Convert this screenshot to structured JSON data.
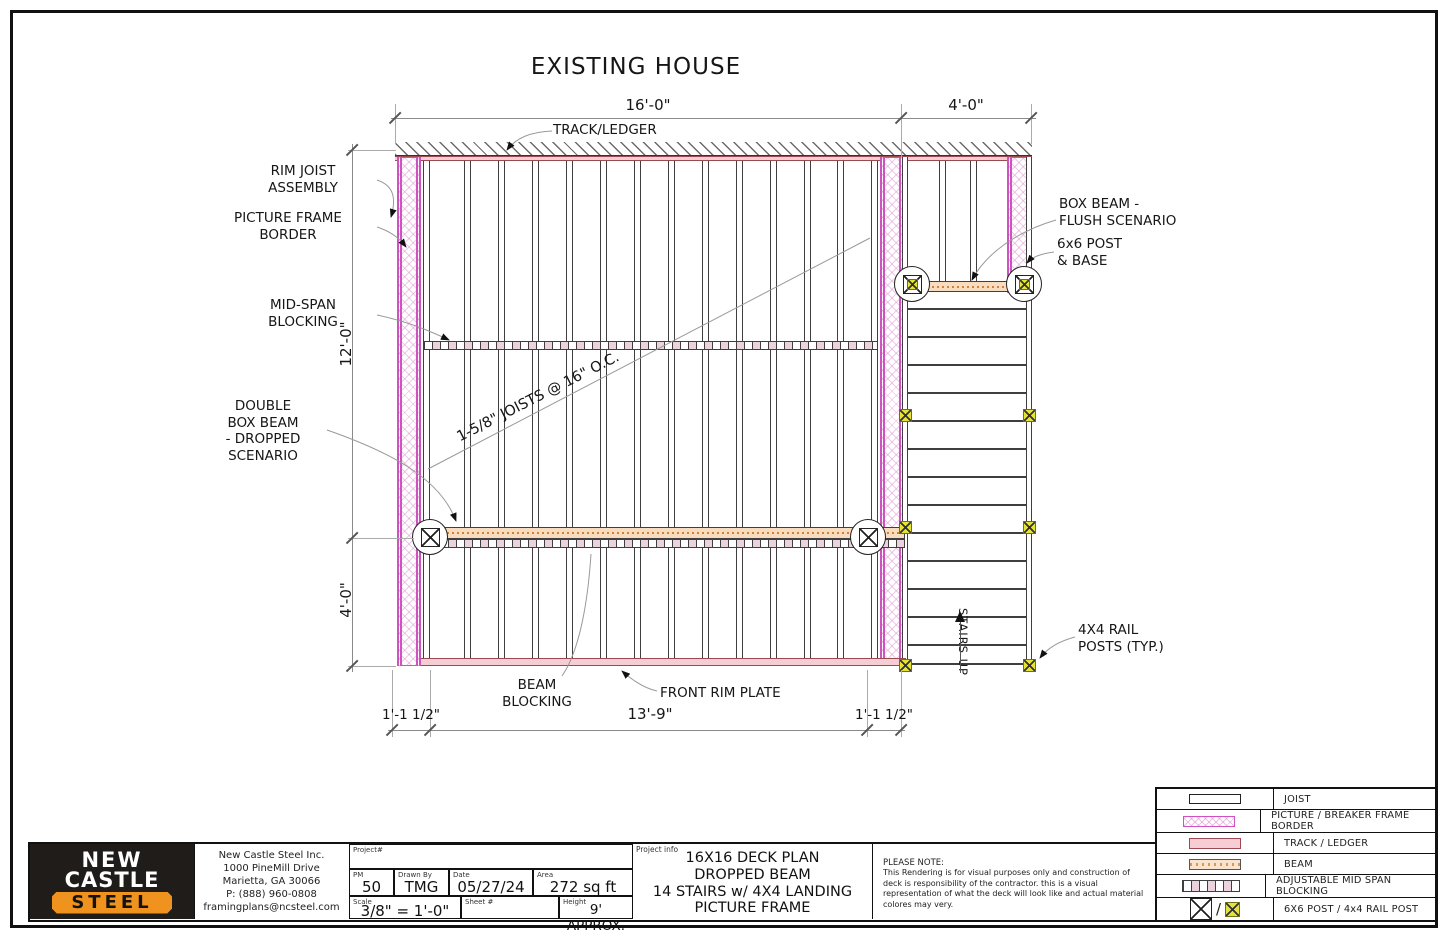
{
  "sheet": {
    "title": "EXISTING HOUSE"
  },
  "dimensions": {
    "top_main": "16'-0\"",
    "top_landing": "4'-0\"",
    "left_upper": "12'-0\"",
    "left_lower": "4'-0\"",
    "bottom_left": "1'-1 1/2\"",
    "bottom_mid": "13'-9\"",
    "bottom_right": "1'-1 1/2\""
  },
  "annotations": {
    "track_ledger": "TRACK/LEDGER",
    "rim_joist": "RIM JOIST\nASSEMBLY",
    "picture_frame": "PICTURE FRAME\nBORDER",
    "mid_span": "MID-SPAN\nBLOCKING",
    "double_box_beam": "DOUBLE\nBOX BEAM\n- DROPPED\nSCENARIO",
    "box_beam_flush": "BOX BEAM -\nFLUSH SCENARIO",
    "post_base": "6x6 POST\n& BASE",
    "rail_posts": "4X4 RAIL\nPOSTS (TYP.)",
    "beam_blocking": "BEAM\nBLOCKING",
    "front_rim_plate": "FRONT RIM PLATE",
    "joists_note": "1-5/8\" JOISTS @ 16\" O.C.",
    "stairs_up": "STAIRS UP"
  },
  "legend": {
    "rows": [
      {
        "symbol": "joist-symbol",
        "label": "JOIST"
      },
      {
        "symbol": "picture-frame-symbol",
        "label": "PICTURE / BREAKER FRAME BORDER"
      },
      {
        "symbol": "track-ledger-symbol",
        "label": "TRACK / LEDGER"
      },
      {
        "symbol": "beam-symbol",
        "label": "BEAM"
      },
      {
        "symbol": "mid-span-blocking-symbol",
        "label": "ADJUSTABLE MID SPAN BLOCKING"
      },
      {
        "symbol": "post-symbols",
        "label": "6X6 POST / 4x4 RAIL POST"
      }
    ]
  },
  "title_block": {
    "logo": {
      "line1": "NEW",
      "line2": "CASTLE",
      "line3": "STEEL"
    },
    "address": "New Castle Steel Inc.\n1000 PineMill Drive\nMarietta, GA 30066\nP: (888) 960-0808\nframingplans@ncsteel.com",
    "fields": {
      "project_label": "Project#",
      "project_value": "",
      "pm_label": "PM",
      "pm_value": "50",
      "drawn_label": "Drawn By",
      "drawn_value": "TMG",
      "date_label": "Date",
      "date_value": "05/27/24",
      "area_label": "Area",
      "area_value": "272 sq ft",
      "scale_label": "Scale",
      "scale_value": "3/8\" = 1'-0\"",
      "sheet_label": "Sheet #",
      "sheet_value": "",
      "height_label": "Height",
      "height_value": "9' APPROX."
    },
    "project_info_label": "Project info",
    "project_info": "16X16 DECK PLAN\nDROPPED BEAM\n14 STAIRS w/ 4X4 LANDING\nPICTURE FRAME",
    "note_title": "PLEASE NOTE:",
    "note_body": "This Rendering is for visual purposes only and construction of deck is responsibility of the contractor. this is a visual representation of what the deck will look like and actual material colores may very."
  },
  "colors": {
    "frame_border_magenta": "#cf52c1",
    "track_pink": "#f6cdd4",
    "beam_tan": "#f7dcc0",
    "rail_post_yellow": "#e4e23a",
    "logo_orange": "#f0921e",
    "line_dark": "#3f3f3f"
  }
}
